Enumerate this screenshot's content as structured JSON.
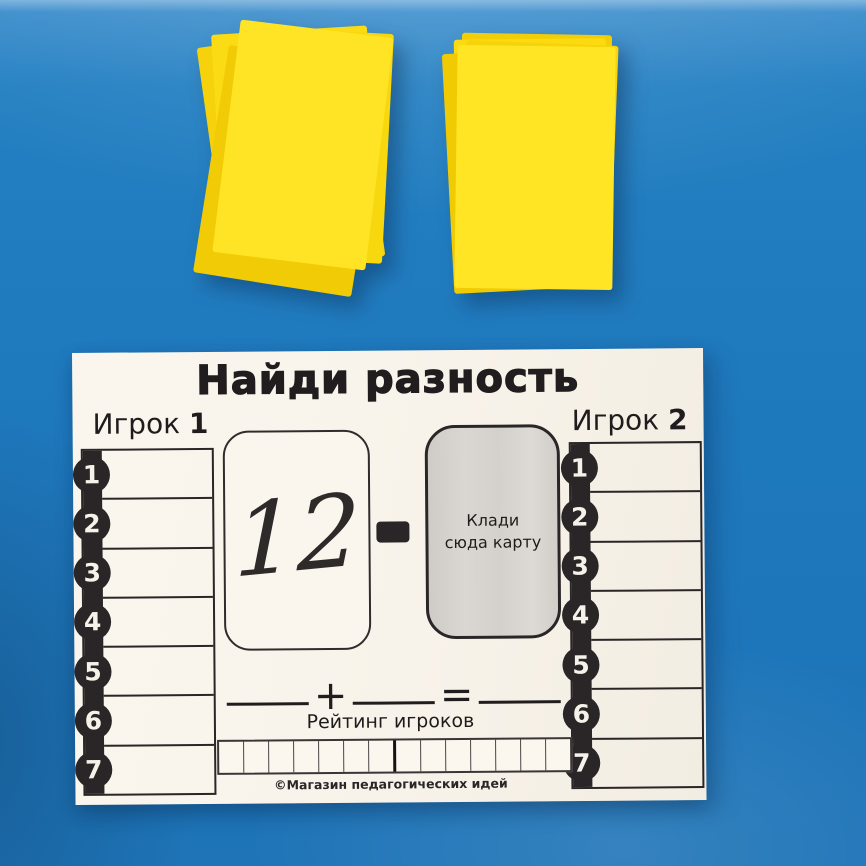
{
  "scene": {
    "background_color": "#1E78BC",
    "objects": {
      "left_stack": {
        "kind": "stack of yellow cards",
        "card_color": "#FFE426"
      },
      "right_stack": {
        "kind": "stack of yellow cards",
        "card_color": "#FFE524"
      }
    }
  },
  "board": {
    "title": "Найди разность",
    "players": [
      {
        "name": "Игрок",
        "number": "1",
        "slots": [
          "1",
          "2",
          "3",
          "4",
          "5",
          "6",
          "7"
        ]
      },
      {
        "name": "Игрок",
        "number": "2",
        "slots": [
          "1",
          "2",
          "3",
          "4",
          "5",
          "6",
          "7"
        ]
      }
    ],
    "minuend_card": {
      "value": "12"
    },
    "operator": "-",
    "placement_card": {
      "label": "Клади сюда карту"
    },
    "equation": {
      "plus": "+",
      "equals": "="
    },
    "rating": {
      "label": "Рейтинг игроков",
      "cells": 14
    },
    "copyright": "©Магазин педагогических идей",
    "colors": {
      "board": "#F8F3EA",
      "ink": "#2A2526",
      "placement_card_fill": "#D7D4CF"
    }
  }
}
